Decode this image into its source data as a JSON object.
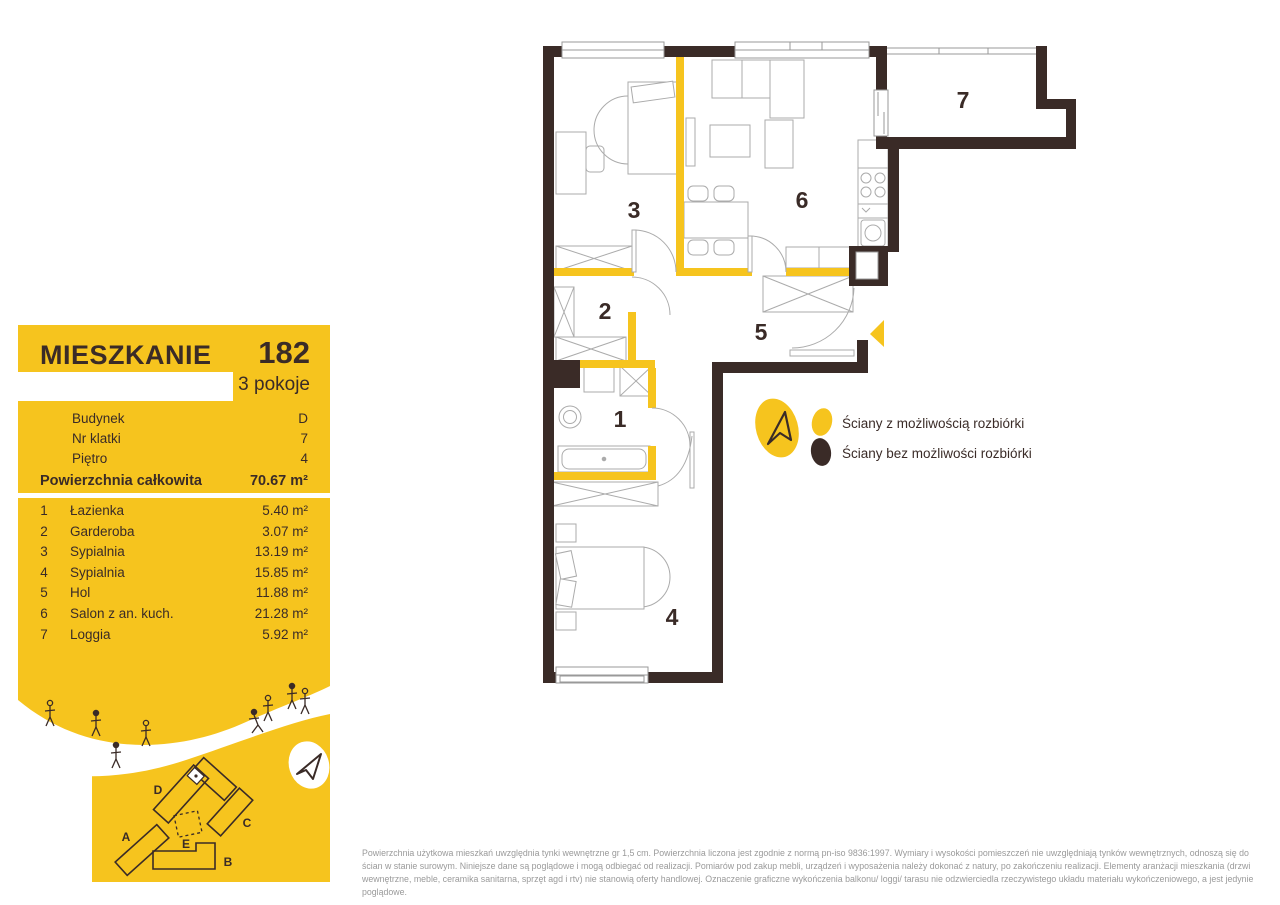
{
  "card": {
    "title": "MIESZKANIE",
    "number": "182",
    "rooms_count": "3 pokoje",
    "info": [
      {
        "label": "Budynek",
        "value": "D"
      },
      {
        "label": "Nr klatki",
        "value": "7"
      },
      {
        "label": "Piętro",
        "value": "4"
      }
    ],
    "total_label": "Powierzchnia całkowita",
    "total_value": "70.67 m²",
    "rooms": [
      {
        "no": "1",
        "name": "Łazienka",
        "area": "5.40 m²"
      },
      {
        "no": "2",
        "name": "Garderoba",
        "area": "3.07 m²"
      },
      {
        "no": "3",
        "name": "Sypialnia",
        "area": "13.19 m²"
      },
      {
        "no": "4",
        "name": "Sypialnia",
        "area": "15.85 m²"
      },
      {
        "no": "5",
        "name": "Hol",
        "area": "11.88 m²"
      },
      {
        "no": "6",
        "name": "Salon z an. kuch.",
        "area": "21.28 m²"
      },
      {
        "no": "7",
        "name": "Loggia",
        "area": "5.92 m²"
      }
    ],
    "site_buildings": [
      "A",
      "B",
      "C",
      "D",
      "E"
    ]
  },
  "plan": {
    "room_numbers": [
      "1",
      "2",
      "3",
      "4",
      "5",
      "6",
      "7"
    ]
  },
  "legend": {
    "demolishable": "Ściany z możliwością rozbiórki",
    "non_demolishable": "Ściany bez możliwości rozbiórki"
  },
  "footer": {
    "disclaimer": "Powierzchnia użytkowa mieszkań uwzględnia tynki wewnętrzne gr 1,5 cm. Powierzchnia liczona jest zgodnie z normą pn-iso 9836:1997. Wymiary i wysokości pomieszczeń nie uwzględniają tynków wewnętrznych, odnoszą się do ścian w stanie surowym. Niniejsze dane są poglądowe i mogą odbiegać od realizacji. Pomiarów pod zakup mebli, urządzeń i wyposażenia należy dokonać z natury, po zakończeniu realizacji. Elementy aranżacji mieszkania (drzwi wewnętrzne, meble, ceramika sanitarna, sprzęt agd i rtv) nie stanowią oferty handlowej. Oznaczenie graficzne wykończenia balkonu/ loggi/ tarasu nie odzwierciedla rzeczywistego układu materiału wykończeniowego, a jest jedynie poglądowe."
  },
  "colors": {
    "accent_yellow": "#F6C41E",
    "wall_dark": "#3A2B27"
  }
}
